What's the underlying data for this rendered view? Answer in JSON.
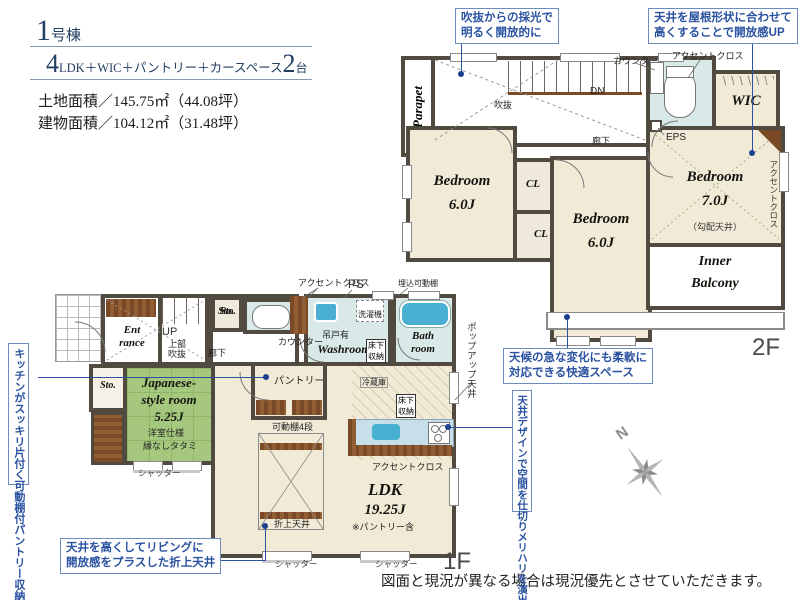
{
  "header": {
    "building_big": "1",
    "building_rest": "号棟",
    "layout_big1": "4",
    "layout_mid": "LDK＋WIC＋パントリー＋カースペース",
    "layout_big2": "2",
    "layout_tail": "台",
    "land_area": "土地面積／145.75㎡（44.08坪）",
    "building_area": "建物面積／104.12㎡（31.48坪）"
  },
  "callouts": {
    "c1": [
      "吹抜からの採光で",
      "明るく開放的に"
    ],
    "c2": [
      "天井を屋根形状に合わせて",
      "高くすることで開放感UP"
    ],
    "c3": [
      "天候の急な変化にも柔軟に",
      "対応できる快適スペース"
    ],
    "c4": "天井デザインで空間を仕切りメリハリを演出",
    "c5": "キッチンがスッキリ片付く可動棚付パントリー収納",
    "c6": [
      "天井を高くしてリビングに",
      "開放感をプラスした折上天井"
    ]
  },
  "plan2f": {
    "parapet": "Parapet",
    "void": "吹抜",
    "dn": "DN",
    "corridor": "廊下",
    "counter": "カウンター",
    "accent_top": "アクセントクロス",
    "wic": "WIC",
    "eps": "EPS",
    "bedroom_l_name": "Bedroom",
    "bedroom_l_size": "6.0J",
    "cl1": "CL",
    "cl2": "CL",
    "bedroom_m_name": "Bedroom",
    "bedroom_m_size": "6.0J",
    "bedroom_r_name": "Bedroom",
    "bedroom_r_size": "7.0J",
    "bedroom_r_note": "（勾配天井）",
    "accent_side": "アクセントクロス",
    "balcony_1": "Inner",
    "balcony_2": "Balcony",
    "floor_label": "2F"
  },
  "plan1f": {
    "entrance_1": "Ent",
    "entrance_2": "rance",
    "up": "UP",
    "upper_void_1": "上部",
    "upper_void_2": "吹抜",
    "corridor": "廊下",
    "sto1": "Sto.",
    "sto2": "Sto.",
    "accent_top": "アクセントクロス",
    "ps": "PS",
    "hang_door": "吊戸有",
    "washroom": "Washroom",
    "underfloor_1a": "床下",
    "underfloor_1b": "収納",
    "washer": "洗濯機",
    "recessed_shelf": "埋込可動棚",
    "bath_1": "Bath",
    "bath_2": "room",
    "popup_ceiling": "ポップアップ天井",
    "counter": "カウンター",
    "pantry": "パントリー",
    "shelf4": "可動棚4段",
    "jroom_1": "Japanese-",
    "jroom_2": "style room",
    "jroom_size": "5.25J",
    "jroom_note1": "洋室仕様",
    "jroom_note2": "縁なしタタミ",
    "fridge": "冷蔵庫",
    "underfloor_2a": "床下",
    "underfloor_2b": "収納",
    "accent_kitchen": "アクセントクロス",
    "ldk": "LDK",
    "ldk_size": "19.25J",
    "ldk_note": "※パントリー含",
    "coffered": "折上天井",
    "shutter1": "シャッター",
    "shutter2": "シャッター",
    "shutter3": "シャッター",
    "floor_label": "1F"
  },
  "misc": {
    "compass_n": "N",
    "disclaimer": "図面と現況が異なる場合は現況優先とさせていただきます。"
  }
}
